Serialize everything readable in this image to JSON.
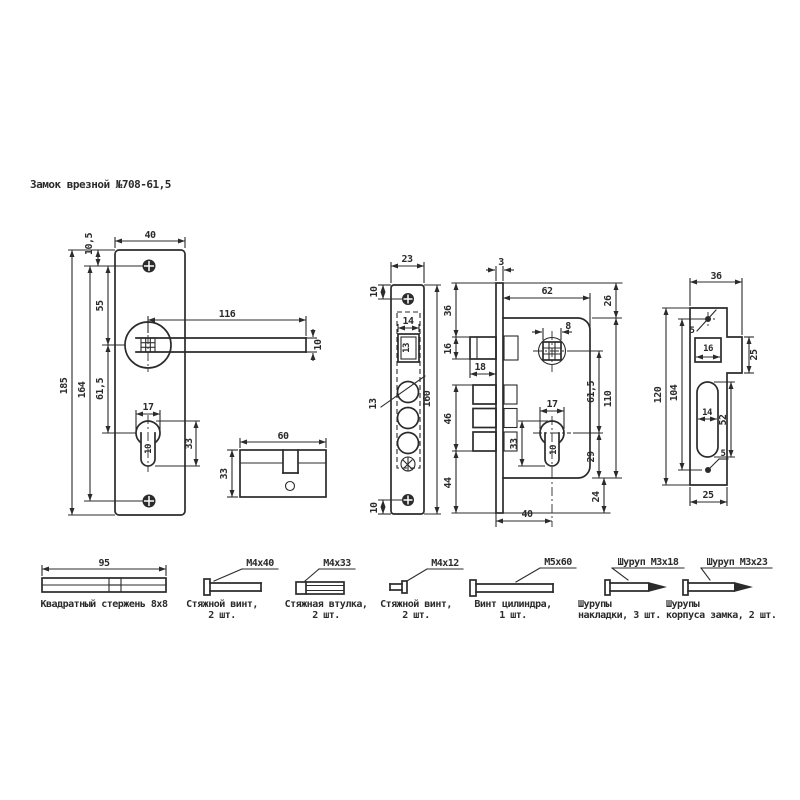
{
  "title": "Замок врезной №708-61,5",
  "colors": {
    "ink": "#2b2b2b",
    "paper": "#ffffff"
  },
  "dims": {
    "escutcheon": {
      "plate_width": "40",
      "top_offset": "10,5",
      "screw_to_handle": "55",
      "handle_length": "116",
      "handle_height": "10",
      "plate_height": "185",
      "screw_spacing": "164",
      "handle_to_cylinder": "61,5",
      "cyl_width": "17",
      "cyl_slot": "10",
      "cyl_height": "33"
    },
    "cylinder": {
      "length": "60",
      "height": "33"
    },
    "faceplate": {
      "width": "23",
      "top_screw": "10",
      "latch_width": "14",
      "latch_mark": "13",
      "hole_dia": "13",
      "height": "160",
      "bottom_screw": "10"
    },
    "side": {
      "thickness": "3",
      "top_to_latch": "36",
      "latch_height": "16",
      "latch_throw": "18",
      "bolt_span": "46",
      "bottom": "44"
    },
    "body": {
      "depth": "62",
      "top_margin": "26",
      "spindle": "8",
      "axes": "61,5",
      "height": "110",
      "cyl_width": "17",
      "cyl_slot": "10",
      "cyl_height": "33",
      "cyl_bottom": "29",
      "bottom_margin": "24",
      "backset": "40"
    },
    "strike": {
      "total_width": "36",
      "hole_top": "5",
      "lip": "25",
      "latch_hole": "16",
      "height": "120",
      "holes_span": "104",
      "slot_width": "14",
      "slot_height": "52",
      "plate_width": "25",
      "hole_bottom": "5"
    }
  },
  "hardware": [
    {
      "dim": "95",
      "size": "",
      "line1": "Квадратный стержень 8х8",
      "line2": ""
    },
    {
      "size": "М4х40",
      "line1": "Стяжной винт,",
      "line2": "2 шт."
    },
    {
      "size": "М4х33",
      "line1": "Стяжная втулка,",
      "line2": "2 шт."
    },
    {
      "size": "М4х12",
      "line1": "Стяжной винт,",
      "line2": "2 шт."
    },
    {
      "size": "М5х60",
      "line1": "Винт цилиндра,",
      "line2": "1 шт."
    },
    {
      "size": "Шуруп М3х18",
      "line1": "Шурупы",
      "line2": "накладки, 3 шт."
    },
    {
      "size": "Шуруп М3х23",
      "line1": "Шурупы",
      "line2": "корпуса замка, 2 шт."
    }
  ]
}
